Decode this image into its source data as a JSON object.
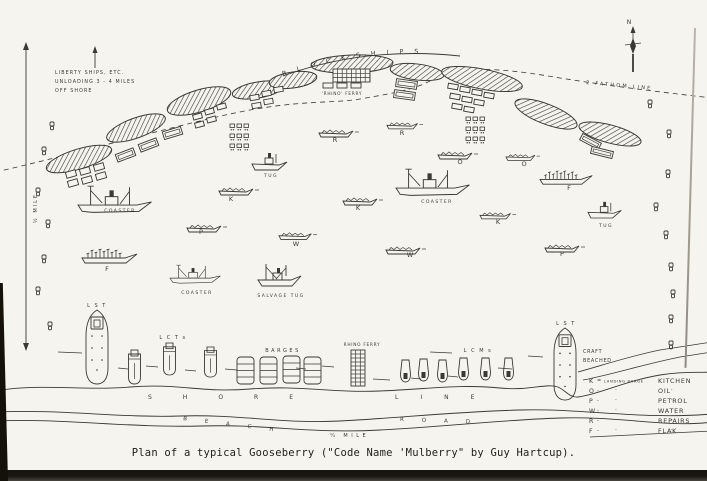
{
  "caption": "Plan of a typical Gooseberry (\"Code Name 'Mulberry\" by Guy Hartcup).",
  "diagram": {
    "titles": {
      "blockships": "BLOCKSHIPS",
      "fathom": "2 FATHOM LINE",
      "rhino_top": "'RHINO' FERRY",
      "north": "N",
      "half_mile": "½ MILE",
      "quarter_mile": "¼ MILE",
      "shore1": "SHORE",
      "shore2": "LINE",
      "beach1": "BEACH",
      "beach2": "ROAD"
    },
    "liberty_note": [
      "LIBERTY SHIPS, ETC.",
      "UNLOADING 3 - 4 MILES",
      "OFF SHORE"
    ],
    "ships": [
      {
        "type": "coaster",
        "label": "COASTER",
        "x": 78,
        "y": 183,
        "s": 1.05,
        "lx": 120,
        "ly": 212
      },
      {
        "type": "coaster",
        "label": "COASTER",
        "x": 396,
        "y": 166,
        "s": 1.05,
        "lx": 437,
        "ly": 203
      },
      {
        "type": "coaster",
        "label": "COASTER",
        "x": 170,
        "y": 263,
        "s": 0.72,
        "lx": 197,
        "ly": 294
      },
      {
        "type": "tug",
        "label": "TUG",
        "x": 252,
        "y": 150,
        "s": 1,
        "lx": 271,
        "ly": 177
      },
      {
        "type": "tug",
        "label": "TUG",
        "x": 588,
        "y": 199,
        "s": 0.95,
        "lx": 606,
        "ly": 227
      },
      {
        "type": "salvage",
        "label": "SALVAGE TUG",
        "x": 258,
        "y": 262,
        "s": 1,
        "lx": 281,
        "ly": 297
      },
      {
        "type": "flak",
        "label": "F",
        "x": 82,
        "y": 246,
        "s": 1,
        "lx": 107,
        "ly": 271
      },
      {
        "type": "flak",
        "label": "F",
        "x": 540,
        "y": 168,
        "s": 0.95,
        "lx": 569,
        "ly": 190
      },
      {
        "type": "barge",
        "label": "K",
        "x": 219,
        "y": 184,
        "s": 1,
        "lx": 231,
        "ly": 201
      },
      {
        "type": "barge",
        "label": "K",
        "x": 343,
        "y": 194,
        "s": 1,
        "lx": 358,
        "ly": 210
      },
      {
        "type": "barge",
        "label": "K",
        "x": 480,
        "y": 209,
        "s": 0.9,
        "lx": 498,
        "ly": 224
      },
      {
        "type": "barge",
        "label": "P",
        "x": 187,
        "y": 221,
        "s": 1,
        "lx": 201,
        "ly": 234
      },
      {
        "type": "barge",
        "label": "P",
        "x": 545,
        "y": 241,
        "s": 1,
        "lx": 562,
        "ly": 256
      },
      {
        "type": "barge",
        "label": "W",
        "x": 279,
        "y": 229,
        "s": 0.95,
        "lx": 296,
        "ly": 246
      },
      {
        "type": "barge",
        "label": "W",
        "x": 386,
        "y": 243,
        "s": 1,
        "lx": 410,
        "ly": 257
      },
      {
        "type": "barge",
        "label": "R",
        "x": 319,
        "y": 126,
        "s": 1,
        "lx": 335,
        "ly": 142
      },
      {
        "type": "barge",
        "label": "R",
        "x": 387,
        "y": 119,
        "s": 0.9,
        "lx": 402,
        "ly": 135
      },
      {
        "type": "barge",
        "label": "O",
        "x": 438,
        "y": 148,
        "s": 1,
        "lx": 460,
        "ly": 164
      },
      {
        "type": "barge",
        "label": "O",
        "x": 506,
        "y": 151,
        "s": 0.85,
        "lx": 524,
        "ly": 166
      }
    ],
    "beach": {
      "lsts": [
        {
          "x": 84,
          "y": 310,
          "h": 76,
          "label": "L S T",
          "lx": 97,
          "ly": 307
        },
        {
          "x": 552,
          "y": 328,
          "h": 74,
          "label": "L S T",
          "lx": 566,
          "ly": 325
        }
      ],
      "craft_beached": [
        "CRAFT",
        "BEACHED"
      ],
      "lcts": {
        "label": "L C T s",
        "lx": 173,
        "ly": 339,
        "items": [
          [
            127,
            350,
            34
          ],
          [
            162,
            343,
            32
          ],
          [
            203,
            347,
            30
          ]
        ]
      },
      "barges": {
        "label": "BARGES",
        "lx": 283,
        "ly": 352,
        "items": [
          [
            237,
            357
          ],
          [
            260,
            357
          ],
          [
            283,
            356
          ],
          [
            304,
            357
          ]
        ]
      },
      "rhino": {
        "label": "RHINO FERRY",
        "lx": 362,
        "ly": 346,
        "x": 351,
        "y": 350
      },
      "lcms": {
        "label": "L C M s",
        "lx": 478,
        "ly": 352,
        "items": [
          [
            400,
            360
          ],
          [
            418,
            359
          ],
          [
            437,
            360
          ],
          [
            458,
            358
          ],
          [
            480,
            358
          ],
          [
            503,
            358
          ]
        ]
      }
    },
    "legend": {
      "rows": [
        {
          "key": "K",
          "dash": "=",
          "mid": "LANDING BARGE",
          "value": "KITCHEN"
        },
        {
          "key": "O",
          "dash": "-",
          "mid": "· ·",
          "value": "OIL"
        },
        {
          "key": "P",
          "dash": "-",
          "mid": "· ·",
          "value": "PETROL"
        },
        {
          "key": "W",
          "dash": "-",
          "mid": "· ·",
          "value": "WATER"
        },
        {
          "key": "R",
          "dash": "-",
          "mid": "· ·",
          "value": "REPAIRS"
        },
        {
          "key": "F",
          "dash": "-",
          "mid": "· ·",
          "value": "FLAK"
        }
      ]
    },
    "blockships": [
      [
        79,
        159,
        34,
        10,
        -17
      ],
      [
        136,
        128,
        31,
        10,
        -20
      ],
      [
        199,
        101,
        33,
        11,
        -17
      ],
      [
        258,
        90,
        26,
        8,
        -10
      ],
      [
        293,
        80,
        24,
        8,
        -8
      ],
      [
        352,
        64,
        41,
        9,
        -2
      ],
      [
        417,
        72,
        27,
        8,
        7
      ],
      [
        482,
        79,
        41,
        10,
        11
      ],
      [
        546,
        114,
        33,
        10,
        21
      ],
      [
        610,
        134,
        32,
        9,
        15
      ]
    ],
    "moored_rects": [
      [
        66,
        171,
        10,
        6,
        -16
      ],
      [
        80,
        168,
        10,
        6,
        -16
      ],
      [
        94,
        164,
        10,
        6,
        -16
      ],
      [
        68,
        180,
        10,
        6,
        -16
      ],
      [
        82,
        177,
        10,
        6,
        -16
      ],
      [
        96,
        173,
        10,
        6,
        -16
      ],
      [
        116,
        151,
        19,
        8,
        -21
      ],
      [
        139,
        141,
        19,
        8,
        -21
      ],
      [
        163,
        129,
        19,
        8,
        -17
      ],
      [
        193,
        114,
        9,
        5,
        -15
      ],
      [
        205,
        109,
        9,
        5,
        -15
      ],
      [
        217,
        104,
        9,
        5,
        -15
      ],
      [
        195,
        122,
        9,
        5,
        -15
      ],
      [
        207,
        117,
        9,
        5,
        -15
      ],
      [
        250,
        95,
        9,
        5,
        -10
      ],
      [
        262,
        91,
        9,
        5,
        -10
      ],
      [
        274,
        87,
        9,
        5,
        -10
      ],
      [
        252,
        103,
        9,
        5,
        -10
      ],
      [
        264,
        99,
        9,
        5,
        -10
      ],
      [
        323,
        83,
        10,
        5,
        0
      ],
      [
        337,
        83,
        10,
        5,
        0
      ],
      [
        351,
        83,
        10,
        5,
        0
      ],
      [
        396,
        80,
        21,
        8,
        8
      ],
      [
        394,
        91,
        21,
        8,
        8
      ],
      [
        448,
        84,
        10,
        5,
        10
      ],
      [
        460,
        87,
        10,
        5,
        10
      ],
      [
        472,
        90,
        10,
        5,
        10
      ],
      [
        484,
        93,
        10,
        5,
        10
      ],
      [
        450,
        94,
        10,
        5,
        10
      ],
      [
        462,
        97,
        10,
        5,
        10
      ],
      [
        474,
        100,
        10,
        5,
        10
      ],
      [
        452,
        104,
        10,
        5,
        10
      ],
      [
        464,
        107,
        10,
        5,
        10
      ],
      [
        580,
        138,
        21,
        7,
        28
      ],
      [
        591,
        149,
        22,
        7,
        14
      ]
    ],
    "buoys": [
      [
        50,
        122
      ],
      [
        42,
        147
      ],
      [
        36,
        188
      ],
      [
        46,
        220
      ],
      [
        42,
        255
      ],
      [
        36,
        287
      ],
      [
        48,
        322
      ],
      [
        648,
        100
      ],
      [
        667,
        130
      ],
      [
        666,
        170
      ],
      [
        654,
        203
      ],
      [
        664,
        231
      ],
      [
        669,
        263
      ],
      [
        671,
        290
      ],
      [
        669,
        315
      ],
      [
        669,
        341
      ]
    ],
    "clusters": [
      [
        230,
        124
      ],
      [
        466,
        117
      ]
    ]
  }
}
